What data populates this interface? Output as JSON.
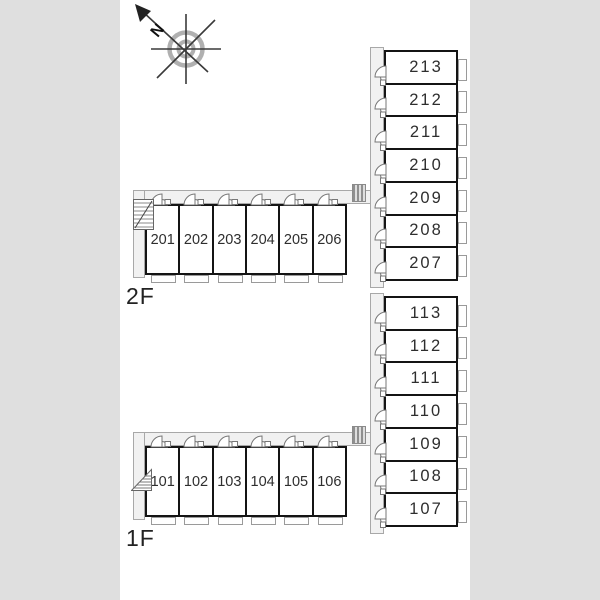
{
  "compass": {
    "north_label": "N"
  },
  "floor_2f": {
    "label": "2F",
    "row_rooms": [
      "201",
      "202",
      "203",
      "204",
      "205",
      "206"
    ],
    "column_rooms": [
      "213",
      "212",
      "211",
      "210",
      "209",
      "208",
      "207"
    ]
  },
  "floor_1f": {
    "label": "1F",
    "row_rooms": [
      "101",
      "102",
      "103",
      "104",
      "105",
      "106"
    ],
    "column_rooms": [
      "113",
      "112",
      "111",
      "110",
      "109",
      "108",
      "107"
    ]
  },
  "colors": {
    "background": "#dfdfdf",
    "canvas": "#ffffff",
    "wall": "#141414",
    "corridor_fill": "#f1f1f1",
    "corridor_line": "#a8a8a8",
    "fixture_line": "#777777"
  }
}
